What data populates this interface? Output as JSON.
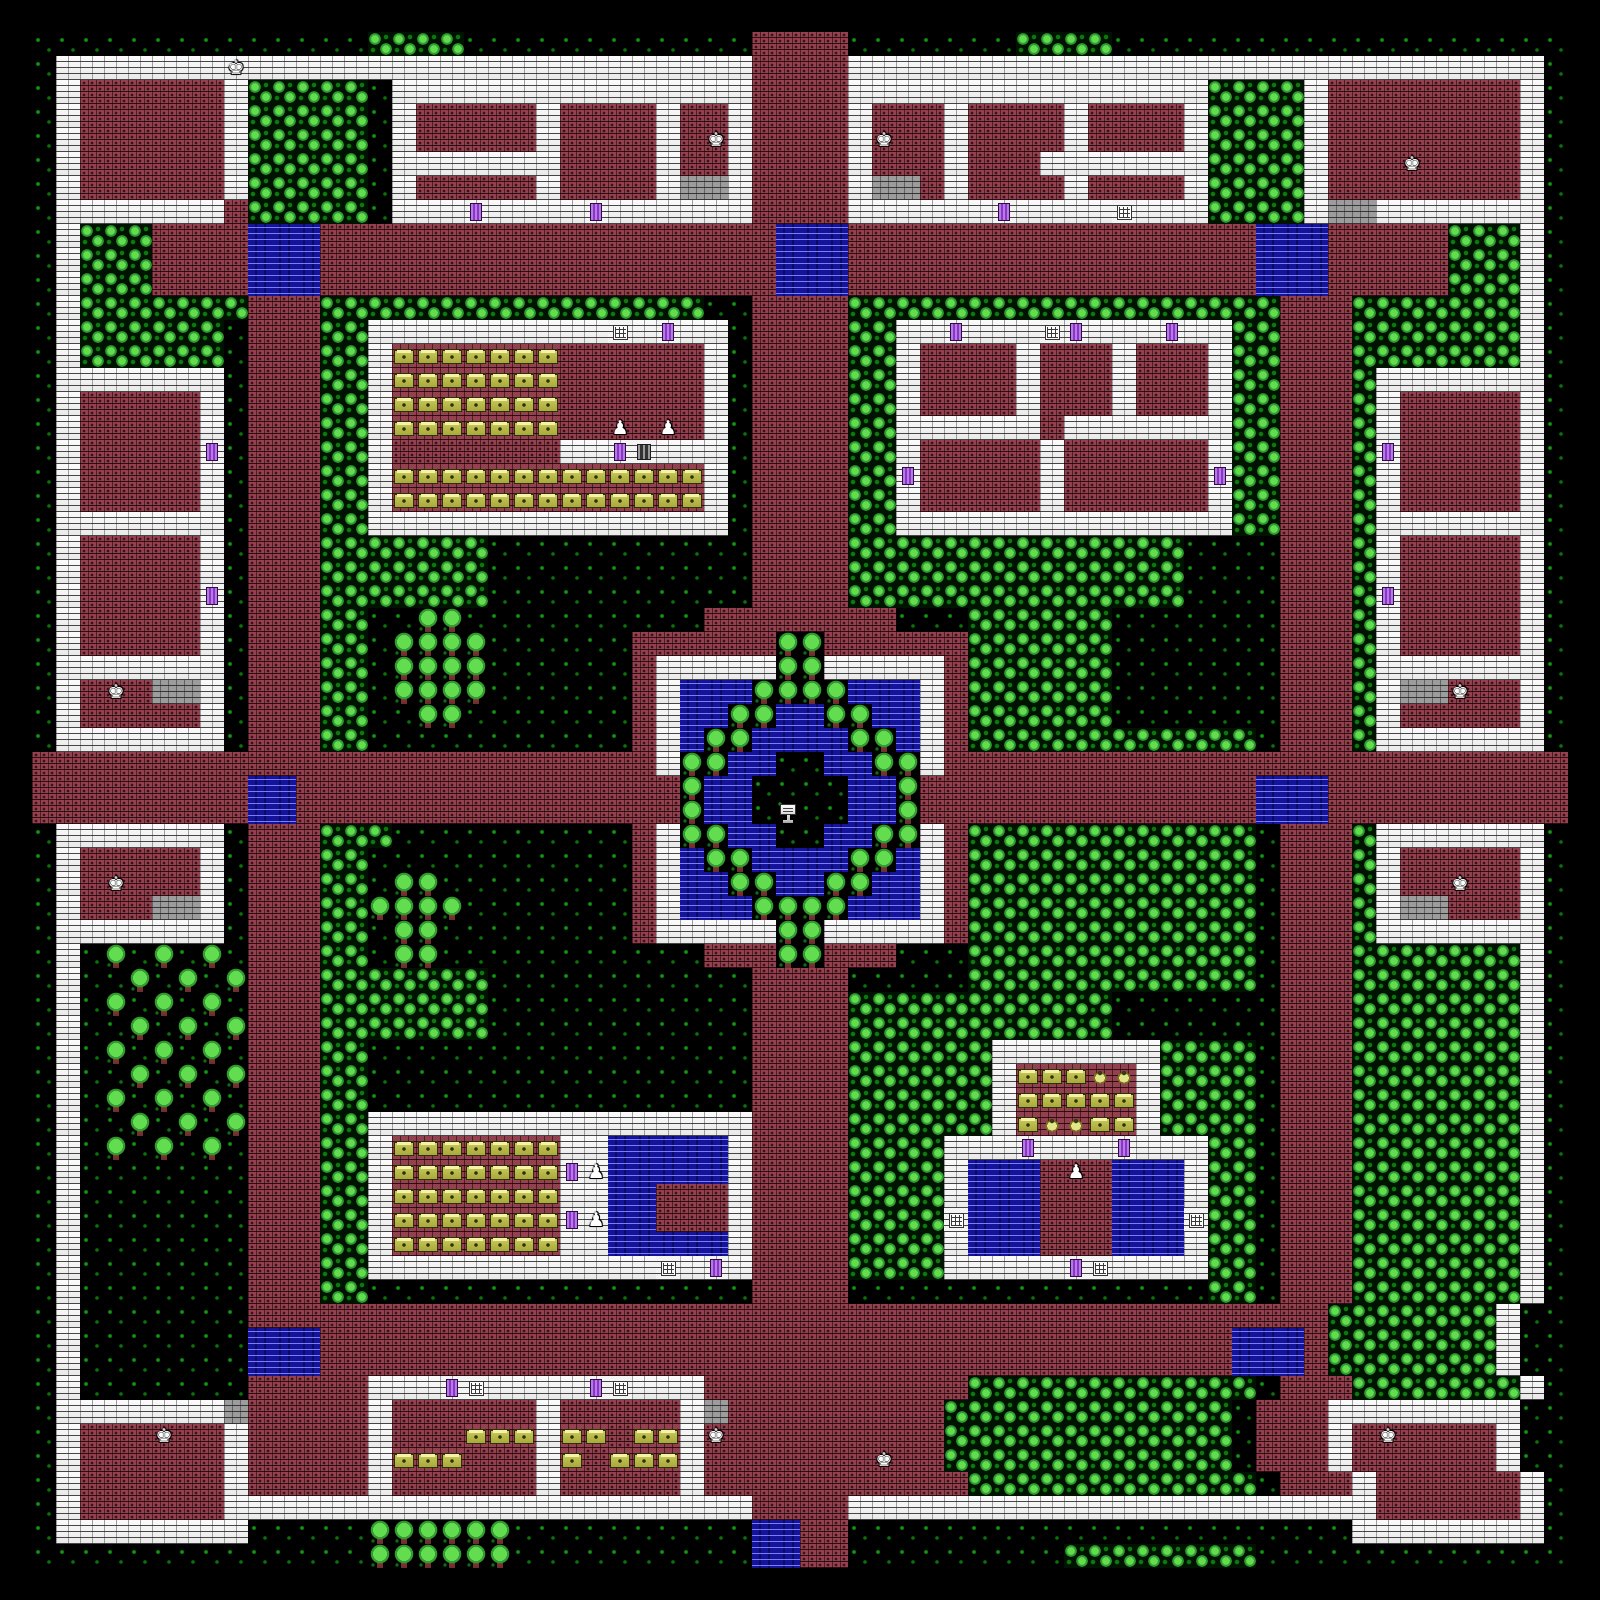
{
  "meta": {
    "scene": "walled-town-overworld-map",
    "style": "8-bit tile RPG"
  },
  "grid": {
    "cols": 64,
    "rows": 64,
    "tile_px": 24,
    "margin_px": 32
  },
  "palette": {
    "background": "#000000",
    "grass_dot": "#0f930f",
    "bush_light": "#64dc50",
    "bush_shade": "#2f9e2f",
    "wall_white": "#f4f4f4",
    "road_brick": "#93414f",
    "water_blue": "#14149a",
    "water_wave": "#7c7cf0",
    "tree_trunk": "#8a3a3a",
    "table_yellow": "#c9c958",
    "table_highlight": "#f2f2a8",
    "door_purple": "#a858d8",
    "passage_gray": "#9c9c9c",
    "npc_white": "#ffffff"
  },
  "legend": {
    ".": {
      "cls": "g",
      "name": "tile-grass",
      "interactable": false
    },
    ",": {
      "cls": "b",
      "name": "tile-bushes",
      "interactable": false
    },
    "#": {
      "cls": "wl",
      "name": "tile-wall",
      "interactable": false
    },
    "r": {
      "cls": "rd",
      "name": "tile-brick-floor",
      "interactable": false
    },
    "w": {
      "cls": "wt",
      "name": "tile-water",
      "interactable": false
    },
    "T": {
      "cls": "tr",
      "name": "tile-tree",
      "interactable": false
    },
    "t": {
      "cls": "tb",
      "name": "shop-table",
      "interactable": false
    },
    "p": {
      "cls": "pt",
      "name": "shop-pot",
      "interactable": false
    },
    "d": {
      "cls": "dr",
      "name": "door",
      "interactable": true
    },
    "G": {
      "cls": "gr",
      "name": "grate-door",
      "interactable": true
    },
    "W": {
      "cls": "wn",
      "name": "window-grate",
      "interactable": true
    },
    "y": {
      "cls": "ps",
      "name": "tile-passage",
      "interactable": false
    },
    "S": {
      "cls": "sn",
      "name": "sign-fountain",
      "interactable": true
    },
    "g": {
      "cls": "wl",
      "name": "npc-guard",
      "interactable": true,
      "glyph": "♚"
    },
    "h": {
      "cls": "rd",
      "name": "npc-guard",
      "interactable": true,
      "glyph": "♚"
    },
    "N": {
      "cls": "wl",
      "name": "npc-shopkeeper",
      "interactable": true,
      "glyph": "♟"
    },
    "n": {
      "cls": "rd",
      "name": "npc-shopkeeper",
      "interactable": true,
      "glyph": "♟"
    }
  },
  "npcs": [
    {
      "type": "guard",
      "x": 8,
      "y": 1
    },
    {
      "type": "guard",
      "x": 28,
      "y": 4
    },
    {
      "type": "guard",
      "x": 35,
      "y": 4
    },
    {
      "type": "guard",
      "x": 57,
      "y": 5
    },
    {
      "type": "guard",
      "x": 3,
      "y": 27
    },
    {
      "type": "guard",
      "x": 59,
      "y": 27
    },
    {
      "type": "guard",
      "x": 3,
      "y": 35
    },
    {
      "type": "guard",
      "x": 59,
      "y": 35
    },
    {
      "type": "guard",
      "x": 5,
      "y": 58
    },
    {
      "type": "guard",
      "x": 28,
      "y": 58
    },
    {
      "type": "guard",
      "x": 57,
      "y": 58
    },
    {
      "type": "guard",
      "x": 36,
      "y": 59
    },
    {
      "type": "shopkeeper",
      "x": 24,
      "y": 16
    },
    {
      "type": "shopkeeper",
      "x": 26,
      "y": 16
    },
    {
      "type": "shopkeeper",
      "x": 23,
      "y": 47
    },
    {
      "type": "shopkeeper",
      "x": 43,
      "y": 47
    },
    {
      "type": "shopkeeper",
      "x": 23,
      "y": 49
    }
  ],
  "map_rows": [
    "..............,,,,............rrrr.......,,,,...................",
    ".#######g#####################rrrr#############################.",
    ".#rrrrrr#,,,,,.###############rrrr###############,,,,#rrrrrrrr#.",
    ".#rrrrrr#,,,,,.#rrrrr#rrrr#rr#rrrr#rrr#rrrr#rrrr#,,,,#rrrrrrrr#.",
    ".#rrrrrr#,,,,,.#rrrrr#rrrr#rh#rrrr#hrr#rrrr#rrrr#,,,,#rrrrrrrr#.",
    ".#rrrrrr#,,,,,.#######rrrr#rr#rrrr#rrr#rrr#######,,,,#rrrhrrrr#.",
    ".#rrrrrr#,,,,,.#rrrrr#rrrr#yy#rrrr#yyr#rrrr#rrrr#,,,,#rrrrrrrr#.",
    ".#######r,,,,,.###d####d######rrrr######d####W###,,,,#yy#######.",
    ".#,,,rrrrwwwrrrrrrrrrrrrrrrrrrrwwwrrrrrrrrrrrrrrrrrwwwrrrrr,,,#.",
    ".#,,,rrrrwwwrrrrrrrrrrrrrrrrrrrwwwrrrrrrrrrrrrrrrrrwwwrrrrr,,,#.",
    ".#,,,rrrrwwwrrrrrrrrrrrrrrrrrrrwwwrrrrrrrrrrrrrrrrrwwwrrrrr,,,#.",
    ".#,,,,,,,rrr,,,,,,,,,,,,,,,,..rrrr,,,,,,,,,,,,,,,,,,rrr,,,,,,,#.",
    ".#,,,,,,.rrr,,##########W#d##.rrrr,,##d###Wd###d##,,rrr,,,,,,,#.",
    ".#,,,,,,.rrr,,#tttttttrrrrrr#.rrrr,,#rrrr#rrr#rrr#,,rrr,,,,,,,#.",
    ".#######.rrr,,#tttttttrrrrrr#.rrrr,,#rrrr#rrr#rrr#,,rrr,#######.",
    ".#rrrrr#.rrr,,#tttttttrrrrrr#.rrrr,,#rrrr#rrr#rrr#,,rrr,#rrrrr#.",
    ".#rrrrr#.rrr,,#tttttttrrnrnr#.rrrr,,######r#######,,rrr,#rrrrr#.",
    ".#rrrrrd.rrr,,#rrrrrrr##dG###.rrrr,,#rrrrr#rrrrrr#,,rrr,drrrrr#.",
    ".#rrrrr#.rrr,,#ttttttttttttt#.rrrr,,drrrrr#rrrrrrd,,rrr,#rrrrr#.",
    ".#rrrrr#.rrr,,#ttttttttttttt#.rrrr,,#rrrrr#rrrrrr#,,rrr,#rrrrr#.",
    ".#######.rrr,,###############.rrrr,,##############,,rrr,#######.",
    ".#rrrrr#.rrr,,,,,,,...........rrrr,,,,,,,,,,,,,,....rrr,#rrrrr#.",
    ".#rrrrr#.rrr,,,,,,,...........rrrr,,,,,,,,,,,,,,....rrr,#rrrrr#.",
    ".#rrrrrd.rrr,,,,,,,...........rrrr,,,,,,,,,,,,,,....rrr,drrrrr#.",
    ".#rrrrr#.rrr,,..TT..........rrrrrrrr...,,,,,,.......rrr,#rrrrr#.",
    ".#rrrrr#.rrr,,.TTTT......rrrrrrTTrrrrrr,,,,,,.......rrr,#rrrrr#.",
    ".#######.rrr,,.TTTT......r#####TT#####r,,,,,,.......rrr,#######.",
    ".#rhryy#.rrr,,.TTTT......r#wwwTTTTwww#r,,,,,,.......rrr,#yyhrr#.",
    ".#rrrrr#.rrr,,..TT.......r#wwTTwwTTww#r,,,,,,.......rrr,#rrrrr#.",
    ".#######.rrr,,...........r#wTTwwwwTTw#r,,,,,,,,,,,,.rrr,#######.",
    "rrrrrrrrrrrrrrrrrrrrrrrrrr#TTww..wwTT#rrrrrrrrrrrrrrrrrrrrrrrrrr",
    "rrrrrrrrrwwrrrrrrrrrrrrrrrrTww....wwTrrrrrrrrrrrrrrwwwrrrrrrrrrr",
    "rrrrrrrrrwwrrrrrrrrrrrrrrrrTww.S..wwTrrrrrrrrrrrrrrwwwrrrrrrrrrr",
    ".#######.rrr,,,..........r#TTww..wwTT#r,,,,,,,,,,,,.rrr,#######.",
    ".#rrrrr#.rrr,,...........r#wTTwwwwTTw#r,,,,,,,,,,,,.rrr,#rrrrr#.",
    ".#rhrrr#.rrr,,.TT........r#wwTTwwTTww#r,,,,,,,,,,,,.rrr,#rrhrr#.",
    ".#rrryy#.rrr,,TTTT.......r#wwwTTTTwww#r,,,,,,,,,,,,.rrr,#yyrrr#.",
    ".#######.rrr,,.TT........r#####TT#####r,,,,,,,,,,,,.rrr,#######.",
    ".#.T.T.T.rrr,,.TT...........rrrTTrrr...,,,,,,,,,,,,.rrr,,,,,,,#.",
    ".#..T.T.Trrr,,,,,,,...........rrrr.....,,,,,,,,,,,,.rrr,,,,,,,#.",
    ".#.T.T.T.rrr,,,,,,,...........rrrr,,,,,,,,,,,.......rrr,,,,,,,#.",
    ".#..T.T.Trrr,,,,,,,...........rrrr,,,,,,,,,,,.......rrr,,,,,,,#.",
    ".#.T.T.T.rrr,,................rrrr,,,,,,#######,,,,.rrr,,,,,,,#.",
    ".#..T.T.Trrr,,................rrrr,,,,,,#tttpp#,,,,.rrr,,,,,,,#.",
    ".#.T.T.T.rrr,,................rrrr,,,,,,#ttttt#,,,,.rrr,,,,,,,#.",
    ".#..T.T.Trrr,,################rrrr,,,,,,#tpptt#,,,,.rrr,,,,,,,#.",
    ".#.T.T.T.rrr,,#ttttttt##wwwww#rrrr,,,,###d###d###,,.rrr,,,,,,,#.",
    ".#.......rrr,,#tttttttdNwwwww#rrrr,,,,#wwwrnrwww#,,.rrr,,,,,,,#.",
    ".#.......rrr,,#ttttttt##wwrrr#rrrr,,,,#wwwrrrwww#,,.rrr,,,,,,,#.",
    ".#.......rrr,,#tttttttdNwwrrr#rrrr,,,,WwwwrrrwwwW,,.rrr,,,,,,,#.",
    ".#.......rrr,,#ttttttt##wwwww#rrrr,,,,#wwwrrrwww#,,.rrr,,,,,,,#.",
    ".#.......rrr,,############W#d#rrrr,,,,#####dW####,,.rrr,,,,,,,#.",
    ".#.......rrr,,................rrrr...............,,.rrr,,,,,,,#.",
    ".#.......rrrrrrrrrrrrrrrrrrrrrrrrrrrrrrrrrrrrrrrrrrrrr,,,,,,,#.",
    ".#.......wwwrrrrrrrrrrrrrrrrrrrrrrrrrrrrrrrrrrrrrrwwwr,,,,,,,#.",
    ".#.......wwwrrrrrrrrrrrrrrrrrrrrrrrrrrrrrrrrrrrrrrwwwr,,,,,,,#.",
    ".#.......rrrrr###dW####dW###rrrrrrrrrrr,,,,,,,,,,,,.rrr,,,,,,,#.",
    ".#######yrrrrr#rrrrrr#rrrrr#yrrrrrrrrr,,,,,,,,,,,,.rrr########.",
    ".#rrrhrr#rrrrr#rrrttt#ttrtt#hrrrrrrrrr,,,,,,,,,,,,.rrr#rhrrrr#.",
    ".#rrrrrr#rrrrr#tttrrr#trttt#rrrrrrrhrr,,,,,,,,,,,,.rrr#rrrrrr#.",
    ".#rrrrrr#rrrrr#rrrrrr#rrrrr#rrrrrrrrrrr,,,,,,,,,,,,.rrr#rrrrrr#.",
    ".#rrrrrr######################rrrr######################rrrrrr#.",
    ".########.....TTTTTT..........wwrr.....................########.",
    "..............TTTTTT..........wwrr.........,,,,,,,,............."
  ]
}
